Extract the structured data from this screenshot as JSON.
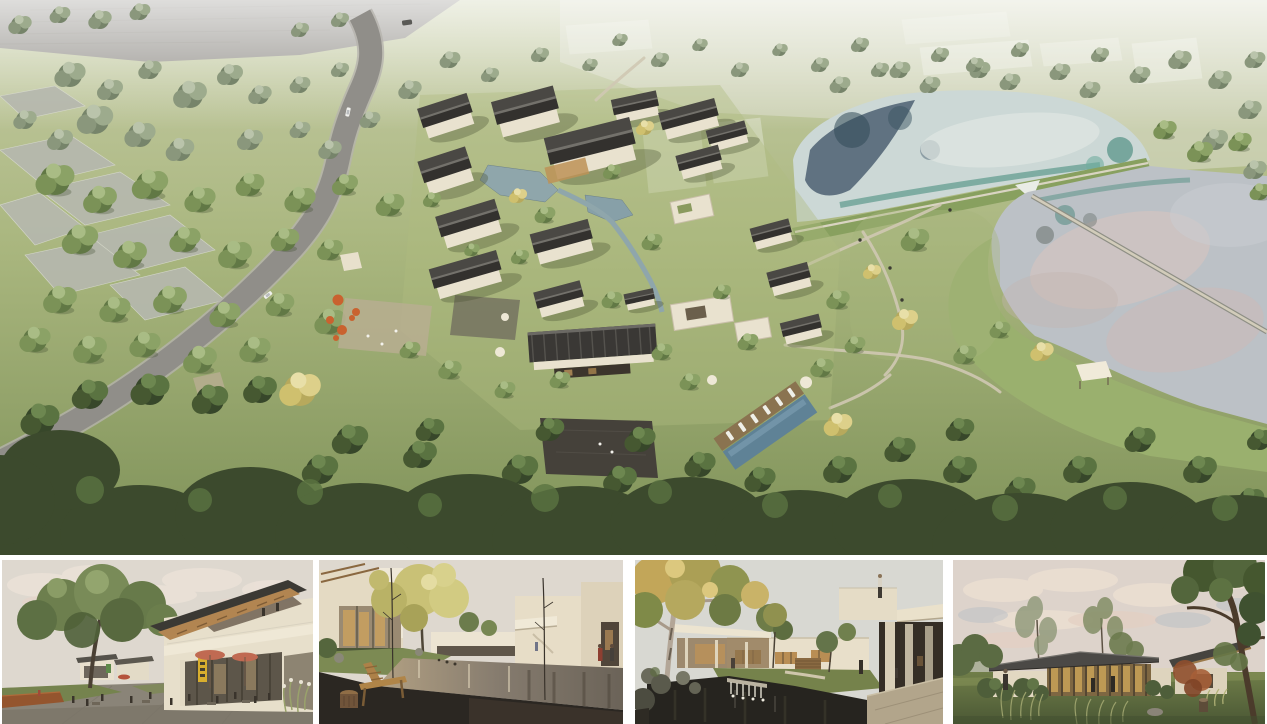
{
  "palette": {
    "page_bg": "#ffffff",
    "grass_light": "#c6cca6",
    "grass_mid": "#a9b67e",
    "grass_deep": "#7e9158",
    "canopy_dark": "#3c4a2d",
    "field_gray": "#8a8781",
    "plot_gray": "#b6b8af",
    "road_gray": "#908e89",
    "roof_dark": "#3a3835",
    "wall_cream": "#e9e2cf",
    "water_upper": "#ccd8d6",
    "water_teal": "#5d9a8c",
    "water_navy": "#45596b",
    "water_lower": "#bcc1c6",
    "water_pink": "#d8c4bf",
    "pool_blue": "#5f8296",
    "deck_wood": "#8a7350",
    "accent_orange": "#c9622f",
    "umbrella_salmon": "#c06a52",
    "sign_yellow": "#d8ae2e",
    "stone_pave": "#8a8478",
    "pond_dark": "#26241f",
    "sky_warm": "#ded8cf",
    "sky_pale": "#d8d8d2",
    "sky_pink": "#ddd3cb",
    "tree_gold": "#c4b566"
  },
  "hero": {
    "name": "aerial-masterplan-rendering"
  },
  "gallery": {
    "items": [
      {
        "name": "street-plaza-rendering"
      },
      {
        "name": "courtyard-pond-rendering"
      },
      {
        "name": "waterfall-courtyard-rendering"
      },
      {
        "name": "lawn-pavilion-rendering"
      }
    ]
  }
}
